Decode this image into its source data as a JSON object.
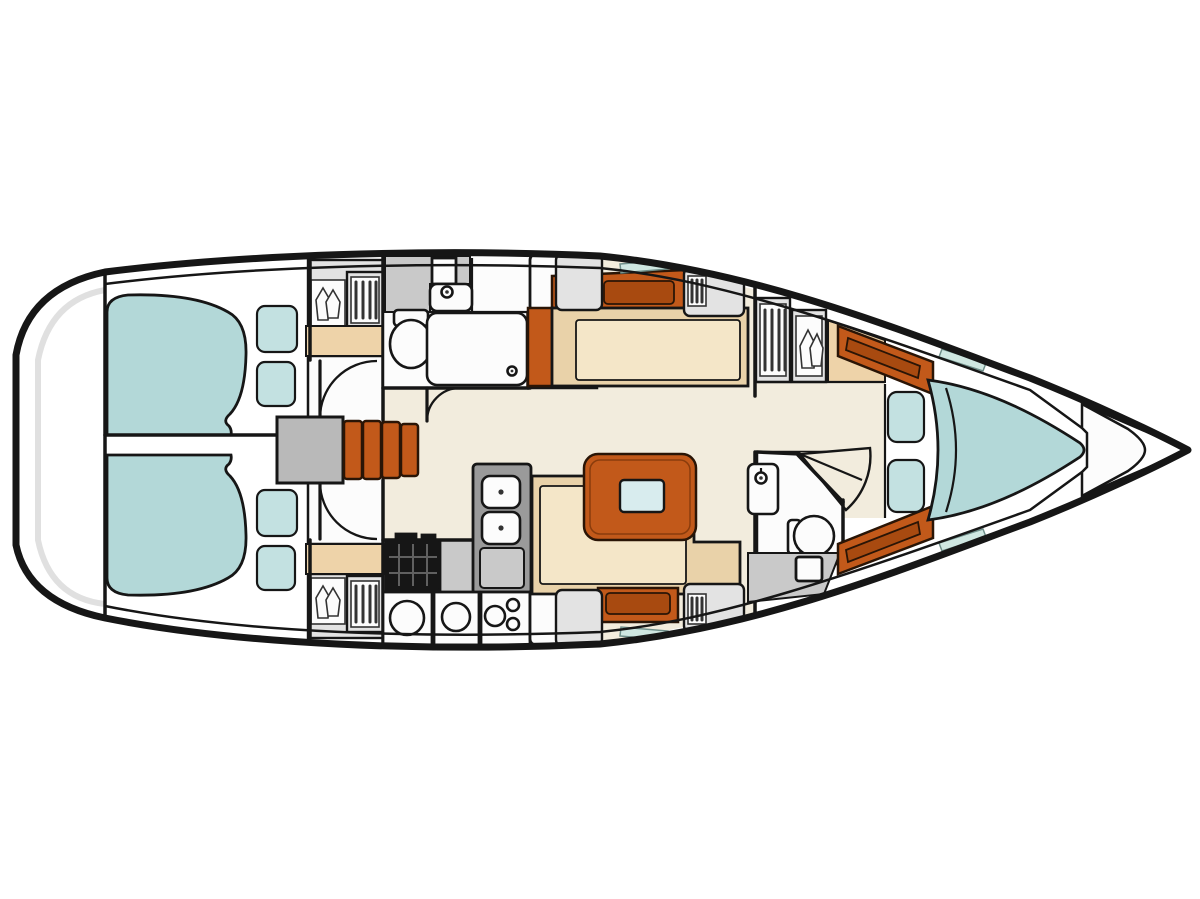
{
  "meta": {
    "title": "Sailboat interior layout plan (top-down line drawing, bow pointing right)",
    "diagram_type": "yacht-floor-plan"
  },
  "colors": {
    "pageBg": "#ffffff",
    "outline": "#161616",
    "hullFill": "#ffffff",
    "floorEcru": "#f2ecdd",
    "roomWhite": "#fcfcfc",
    "bedTeal": "#b3d8d8",
    "pillowTeal": "#c3e1e1",
    "windowTeal": "#cfe7e1",
    "wood": "#c2591a",
    "woodInset": "#a84a10",
    "woodEdge": "#2a1506",
    "benchBeige": "#e9d2a9",
    "benchBeigeLight": "#f4e6c8",
    "shelfBeige": "#eed3a9",
    "grayLight": "#e3e3e3",
    "grayMid": "#c9c9c9",
    "grayDark": "#9a9a9a",
    "platformGray": "#b9b9b9",
    "stoveBlack": "#161616",
    "stoveGrid": "#606060",
    "iconStroke": "#333333",
    "tableInsetBlue": "#d8ecee",
    "transomShade": "#d8d8d8"
  },
  "areas": [
    {
      "name": "stern-transom"
    },
    {
      "name": "aft-cabin-port",
      "features": [
        "double-berth",
        "pillows",
        "wardrobe",
        "louver-locker",
        "shelf",
        "door"
      ]
    },
    {
      "name": "aft-cabin-starboard",
      "features": [
        "double-berth",
        "pillows",
        "wardrobe",
        "louver-locker",
        "shelf",
        "door"
      ]
    },
    {
      "name": "companionway",
      "features": [
        "engine-compartment",
        "steps"
      ]
    },
    {
      "name": "aft-head",
      "features": [
        "toilet",
        "sink",
        "shower",
        "drain",
        "door"
      ]
    },
    {
      "name": "galley",
      "features": [
        "stove",
        "double-sink",
        "fridge",
        "counters"
      ]
    },
    {
      "name": "salon",
      "features": [
        "settee-starboard",
        "settee-port",
        "table-with-leaf",
        "lockers",
        "hull-windows"
      ]
    },
    {
      "name": "forward-head",
      "features": [
        "toilet",
        "sink",
        "shower-fan-door"
      ]
    },
    {
      "name": "forward-cabin",
      "features": [
        "v-berth",
        "cushions",
        "wardrobe",
        "louver-locker",
        "shelf",
        "wood-trim"
      ]
    },
    {
      "name": "bow-anchor-locker"
    }
  ]
}
